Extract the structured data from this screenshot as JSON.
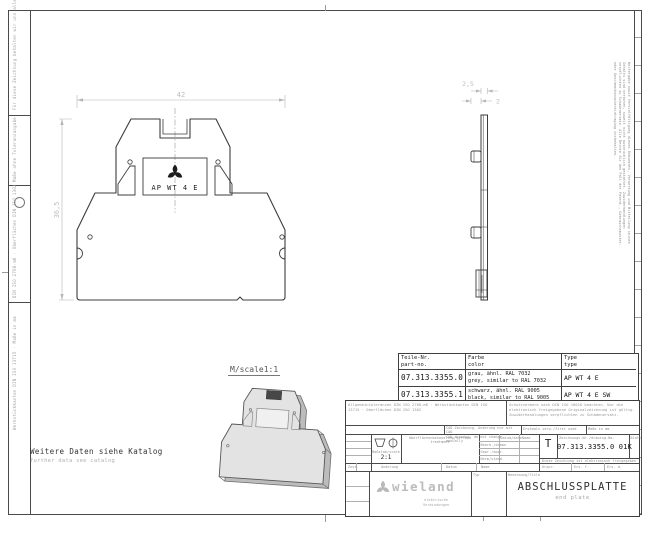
{
  "frame": {
    "left_margin_notes": [
      "Für diese Zeichnung behalten wir uns alle Rechte vor",
      "Maße ohne Toleranzangabe",
      "DIN ISO 2768-mK · Oberflächen DIN ISO 1302",
      "Werkstückkanten DIN ISO 13715 · Maße in mm"
    ],
    "right_copyright": "Weitergabe sowie Vervielfältigung dieses Dokuments, Verwertung und Mitteilung seines Inhalts sind verboten, soweit nicht ausdrücklich gestattet. Zuwiderhandlungen verpflichten zu Schadenersatz. Alle Rechte für den Fall der Patent-, Gebrauchsmuster- oder Geschmacksmustereintragung vorbehalten."
  },
  "drawing": {
    "catalog_note_de": "Weitere Daten siehe Katalog",
    "catalog_note_en": "further data see catalog",
    "scale_note": "M/scale1:1",
    "front_view": {
      "label": "AP WT 4 E",
      "width_dim": "42",
      "height_dim": "36,5"
    },
    "side_view": {
      "thickness_dim": "2,5",
      "depth_dim": "2"
    }
  },
  "parts_table": {
    "col1_de": "Teile-Nr.",
    "col1_en": "part-no.",
    "col2_de": "Farbe",
    "col2_en": "color",
    "col3_de": "Type",
    "col3_en": "type",
    "rows": [
      {
        "part_no": "07.313.3355.0",
        "color_de": "grau, ähnl. RAL 7032",
        "color_en": "grey, similar to RAL 7032",
        "type": "AP WT 4 E"
      },
      {
        "part_no": "07.313.3355.1",
        "color_de": "schwarz, ähnl. RAL 9005",
        "color_en": "black, similar to RAL 9005",
        "type": "AP WT 4 E SW"
      }
    ]
  },
  "title_block": {
    "tolerance_note": "Allgemeintoleranzen DIN ISO 2768-mK · Werkstückkanten DIN ISO 13715 · Oberflächen DIN ISO 1302",
    "protection_note": "Schutzvermerk nach DIN ISO 16016 beachten. Nur die elektronisch freigegebene Originalzeichnung ist gültig. Zuwiderhandlungen verpflichten zu Schadenersatz.",
    "cad_note_de": "CAD-Zeichnung, Änderung nur mit CAD",
    "cad_note_en": "CAD drawing, do not change manually",
    "first_used_label": "Erstmals verw./first used",
    "dim_note": "Maße in mm",
    "scale_label": "Maßstab/scale",
    "scale_value": "2:1",
    "surface_label": "Oberflächenbehandlung/surface treatment",
    "date_col": "Datum/date",
    "name_col": "Name",
    "row_drawn": "Bearb./drawn",
    "row_checked": "Gepr./appr.",
    "row_standard": "Norm/stand.",
    "doc_type": "T",
    "drawing_no_label": "Zeichnungs-Nr./drawing-No.",
    "drawing_no": "07.313.3355.0 01K",
    "sheet_label": "Blatt",
    "release_note": "Diese Zeichnung ist elektronisch freigegeben",
    "rev_state": "Zust.",
    "rev_change": "Änderung",
    "rev_date": "Datum",
    "rev_name": "Name",
    "orig_label": "Urspr.",
    "replaced_by": "Ers. f.",
    "replaces": "Ers. d.",
    "brand": "wieland",
    "brand_tagline_1": "elektrische",
    "brand_tagline_2": "Verbindungen",
    "type_header": "Typ",
    "title_header": "Benennung/Title",
    "title": "ABSCHLUSSPLATTE",
    "subtitle": "end plate"
  }
}
